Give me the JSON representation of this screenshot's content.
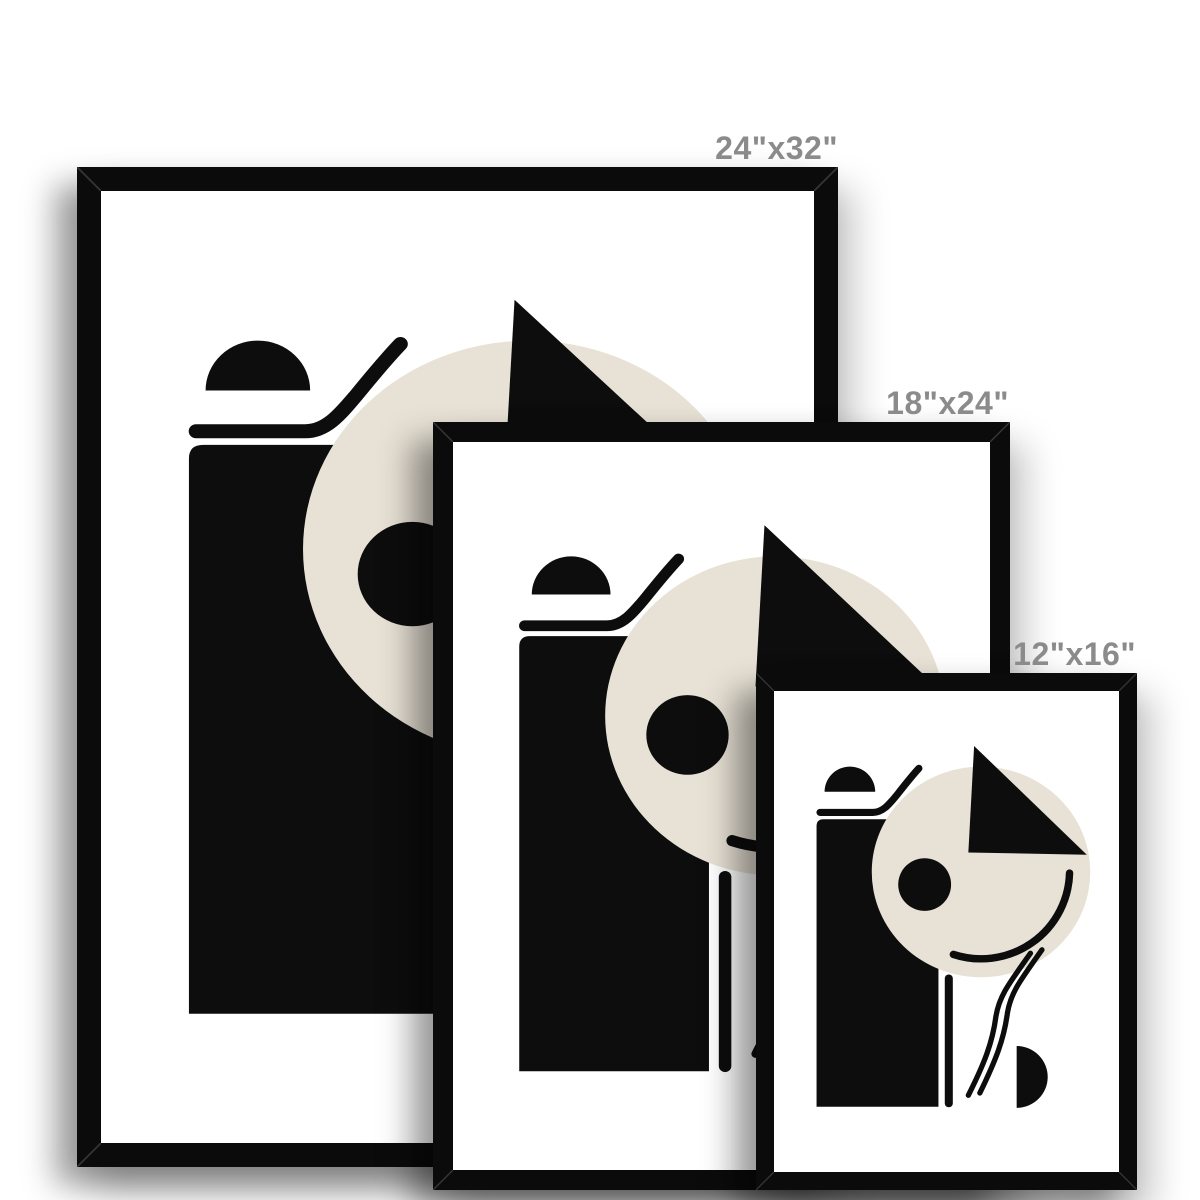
{
  "title": "Framed art print size comparison",
  "theme": {
    "page": "#ffffff",
    "frame": "#0b0b0b",
    "mat": "#ffffff",
    "ink": "#0d0d0d",
    "beige": "#e8e2d6",
    "label": "#8b8b8b"
  },
  "frames": [
    {
      "name": "24x32",
      "label": "24\"x32\"",
      "width_in": 24,
      "height_in": 32
    },
    {
      "name": "18x24",
      "label": "18\"x24\"",
      "width_in": 18,
      "height_in": 24
    },
    {
      "name": "12x16",
      "label": "12\"x16\"",
      "width_in": 12,
      "height_in": 16
    }
  ],
  "artwork": {
    "style": "abstract geometric print, black ink and beige accent on white",
    "shapes": [
      "tall-black-rectangle",
      "black-dome-semicircle",
      "horizontal-line-with-upward-curve",
      "large-beige-circle",
      "black-triangle-wedge",
      "small-black-circle",
      "smile-arc",
      "short-vertical-line",
      "double-wavy-line",
      "black-half-disc"
    ]
  }
}
